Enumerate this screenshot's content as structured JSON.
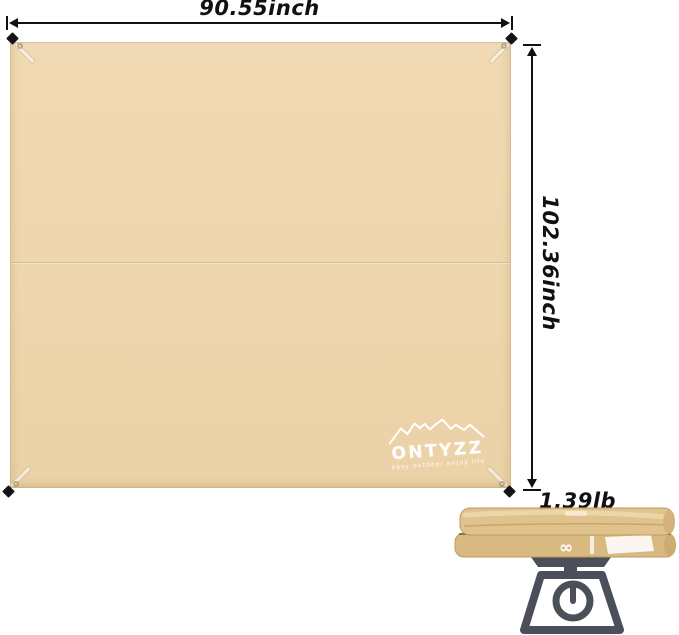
{
  "dimension_labels": {
    "width": "90.55inch",
    "height": "102.36inch",
    "weight": "1.39lb"
  },
  "tarp": {
    "color": "#eed6ae",
    "brand": {
      "name": "ONTYZZ",
      "tagline": "easy outdoor enjoy life"
    }
  },
  "folded_tarp": {
    "color": "#ddbe88",
    "printed_symbol": "∞"
  },
  "icons": {
    "logo": "mountain-range-icon",
    "weight": "kitchen-scale-icon",
    "corners": "stake-diamond-icon"
  },
  "colors": {
    "background": "#ffffff",
    "dimension_lines": "#111111",
    "scale_icon": "#4a4f59",
    "logo_text": "#ffffff"
  }
}
